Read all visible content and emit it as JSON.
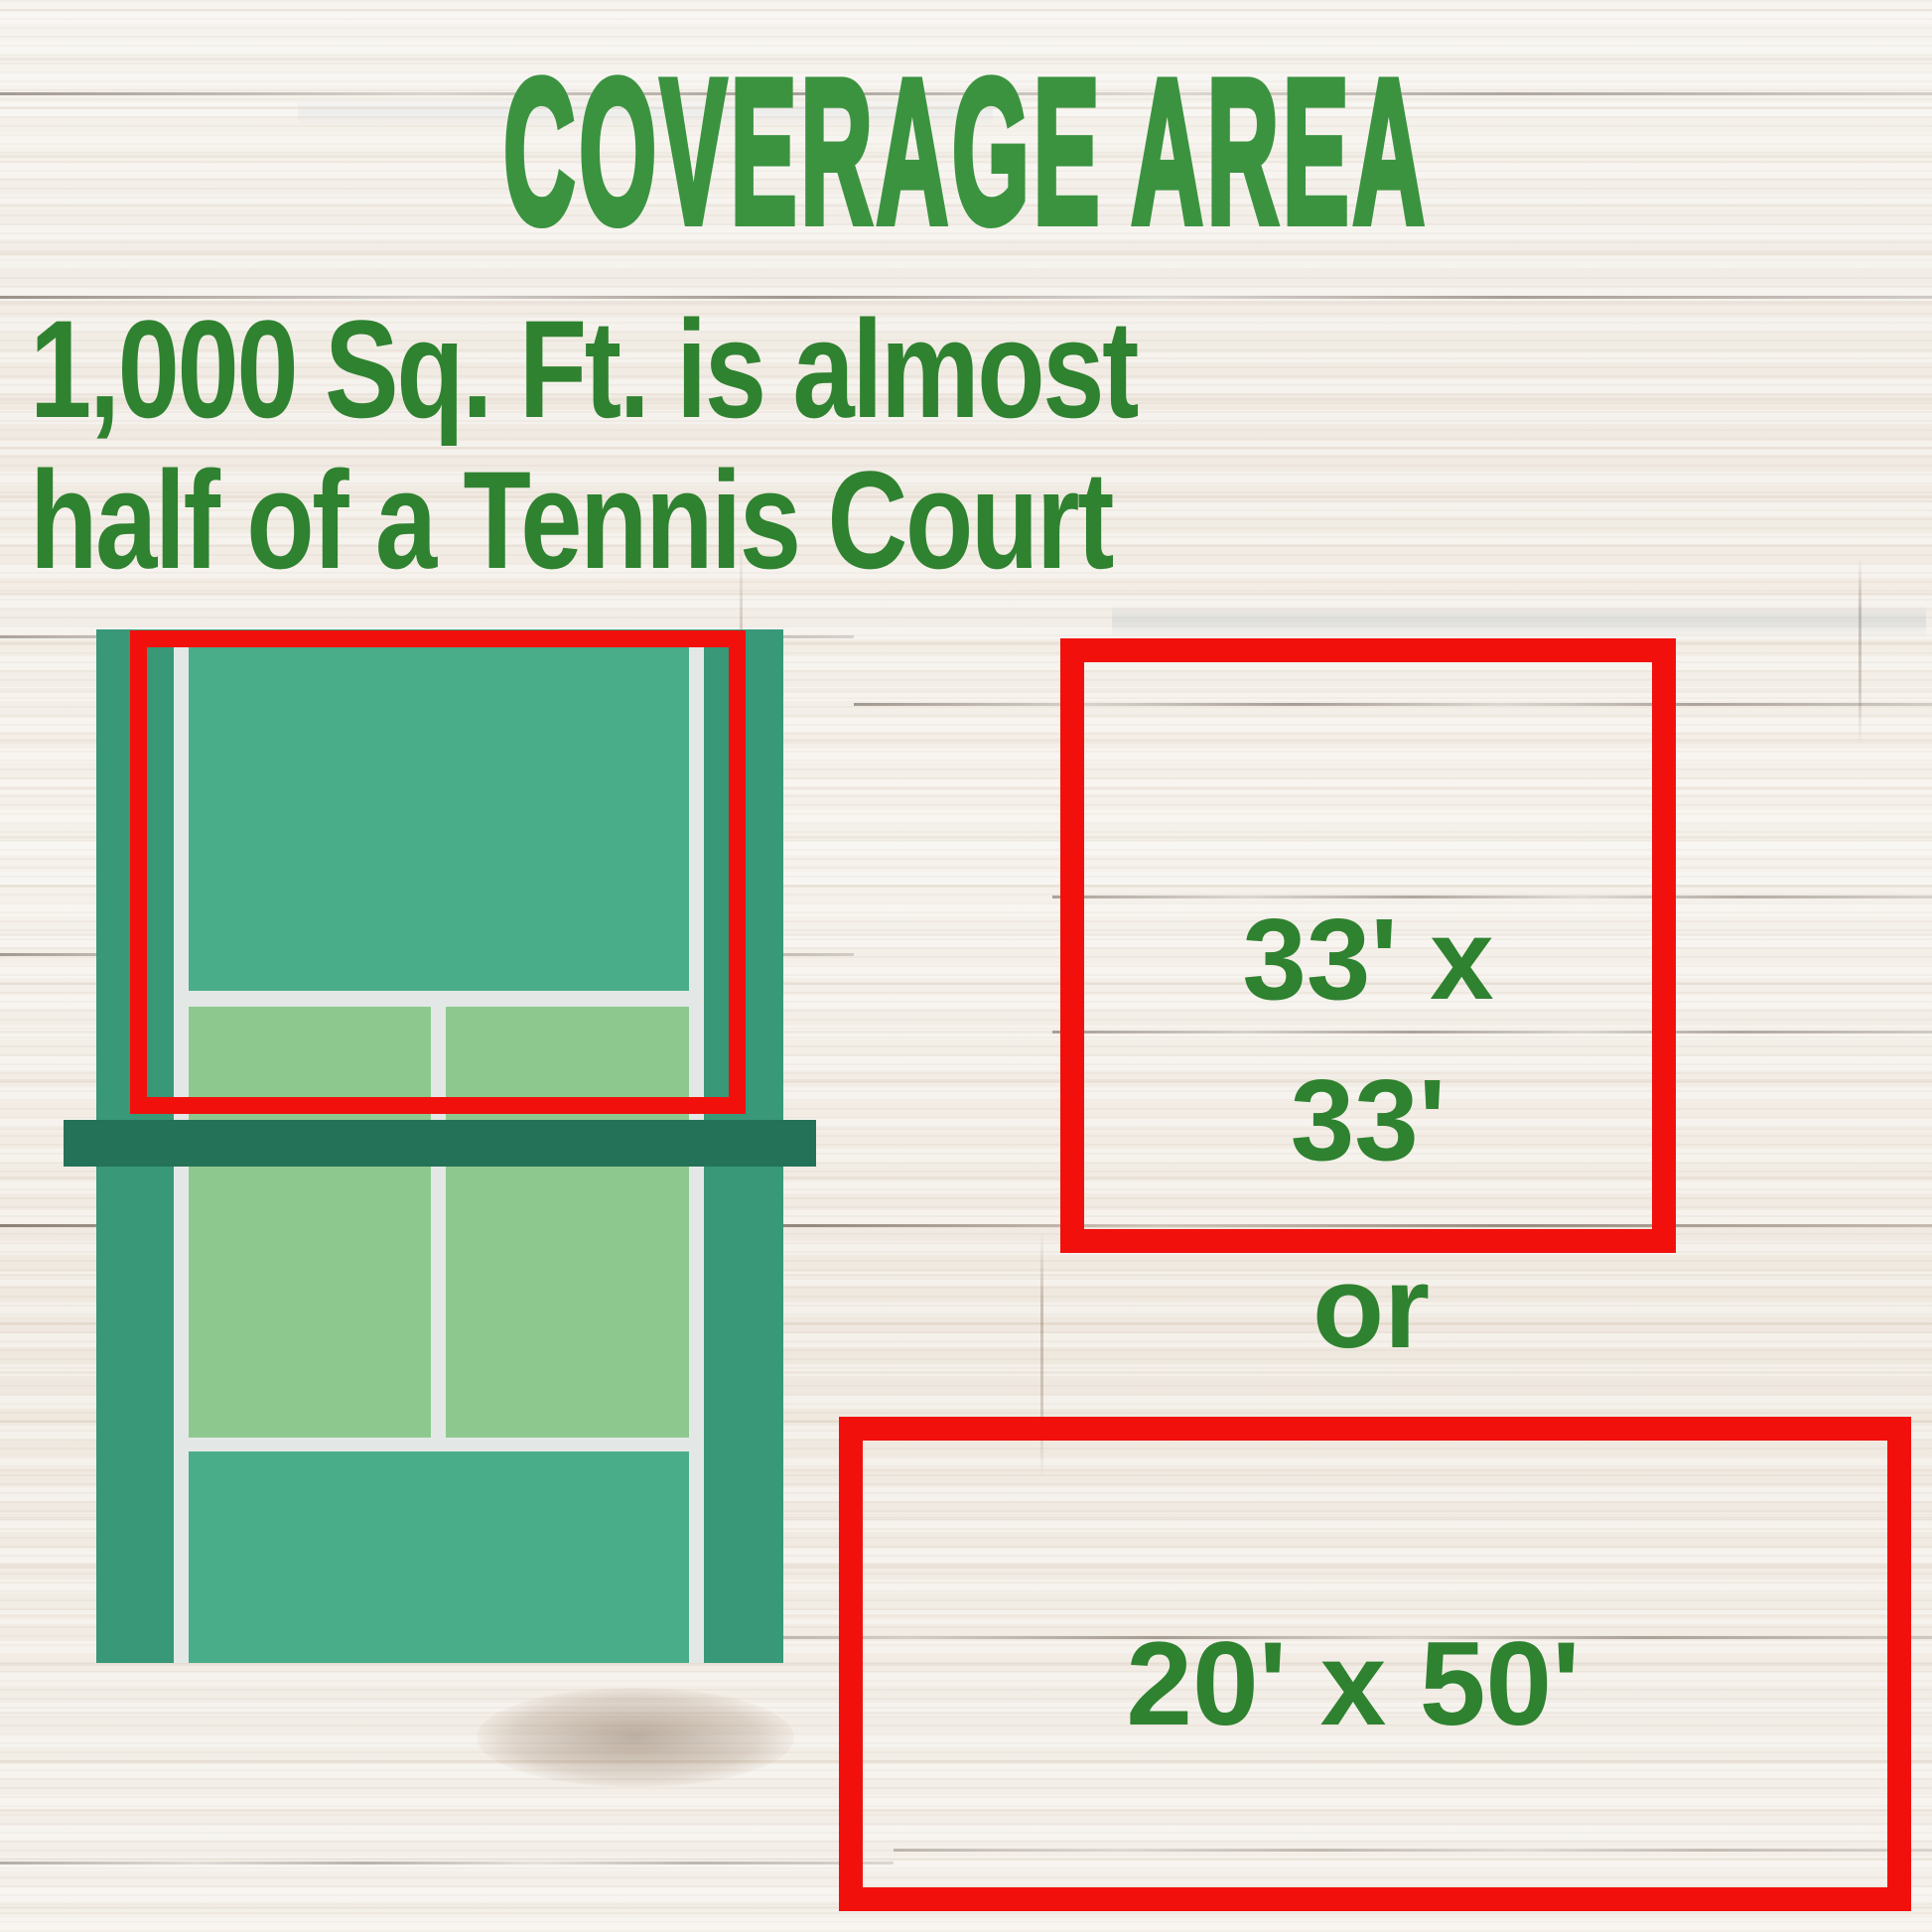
{
  "title": "COVERAGE AREA",
  "subtitle": {
    "line1": "1,000 Sq. Ft. is almost",
    "line2": "half of a Tennis Court"
  },
  "diagram": {
    "square_box": {
      "line1": "33' x",
      "line2": "33'"
    },
    "or_label": "or",
    "rect_box": {
      "label": "20' x 50'"
    }
  },
  "colors": {
    "title-green": "#3B9340",
    "text-green": "#2F8230",
    "outline-red": "#F2100D",
    "court-teal": "#4AAD89",
    "court-teal-dark": "#389878",
    "court-light-green": "#8DC98E",
    "court-line": "#E3E8E6",
    "net-green": "#247257",
    "wood-base": "#F2EEE8"
  }
}
